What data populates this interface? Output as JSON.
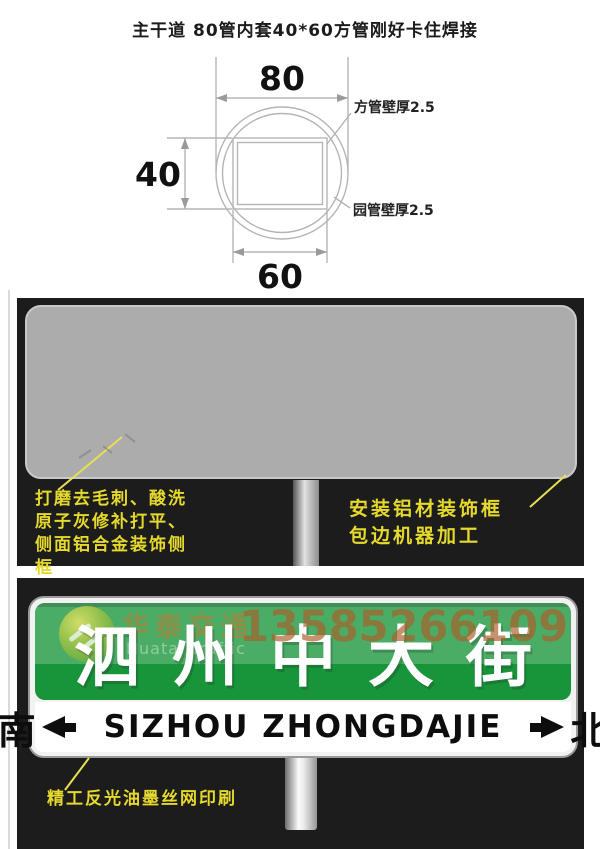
{
  "top_diagram": {
    "title": "主干道 80管内套40*60方管刚好卡住焊接",
    "dim_top": "80",
    "dim_left": "40",
    "dim_bottom": "60",
    "label_square_tube_wall": "方管壁厚2.5",
    "label_round_tube_wall": "园管壁厚2.5",
    "line_color": "#b5b5b5"
  },
  "middle_panel": {
    "bg_color": "#1c1c1c",
    "blank_sign_color": "#acacac",
    "annotation_color": "#e4d92c",
    "left_note_lines": [
      "打磨去毛刺、酸洗",
      "原子灰修补打平、",
      "侧面铝合金装饰侧",
      "框"
    ],
    "right_note_lines": [
      "安装铝材装饰框",
      "包边机器加工"
    ]
  },
  "bottom_panel": {
    "bg_color": "#1c1c1c",
    "sign": {
      "green_color": "#18953a",
      "green_highlight": "rgba(255,255,255,0.22)",
      "street_name_cn": "泗州中大街",
      "strip_left_cn": "南",
      "strip_latin": "SIZHOU ZHONGDAJIE",
      "strip_right_cn": "北"
    },
    "note": "精工反光油墨丝网印刷",
    "watermark": {
      "brand_cn": "华泰交通",
      "brand_en": "Huatai Traffic",
      "phone": "13585266109",
      "phone_color": "rgba(172,95,43,0.68)"
    },
    "icons": {
      "left_arrow": "arrow-left-icon",
      "right_arrow": "arrow-right-icon"
    }
  }
}
